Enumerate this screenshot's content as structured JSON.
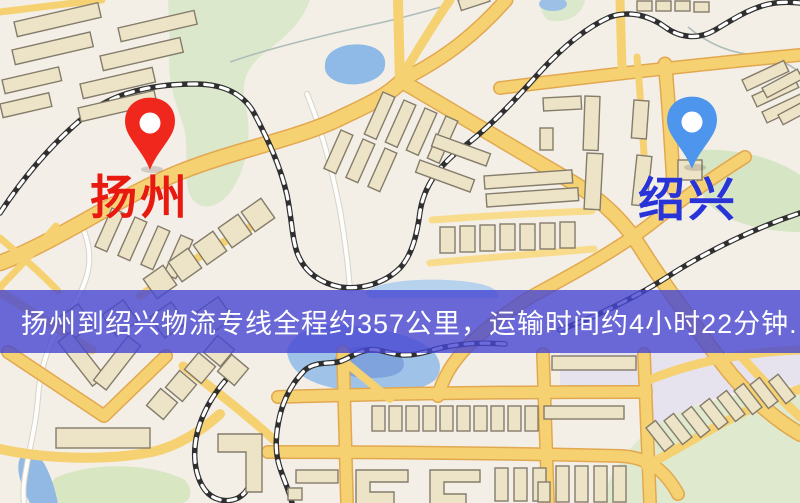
{
  "banner": {
    "text": "扬州到绍兴物流专线全程约357公里，运输时间约4小时22分钟."
  },
  "markers": {
    "origin": {
      "label": "扬州"
    },
    "destination": {
      "label": "绍兴"
    }
  },
  "colors": {
    "banner_background": "rgba(70,70,210,0.80)",
    "banner_text": "#ffffff",
    "origin_pin": "#f0271c",
    "origin_label": "#e8190f",
    "destination_pin": "#4e95ee",
    "destination_label": "#2833d8",
    "map_background": "#f3efe7",
    "road_yellow": "#f6d171",
    "road_casing": "#e2a850",
    "park_green": "#dbe8cb",
    "water_blue": "#a0c4e8",
    "building_fill": "#ede4c8",
    "railway_dark": "#2f2f2f"
  }
}
